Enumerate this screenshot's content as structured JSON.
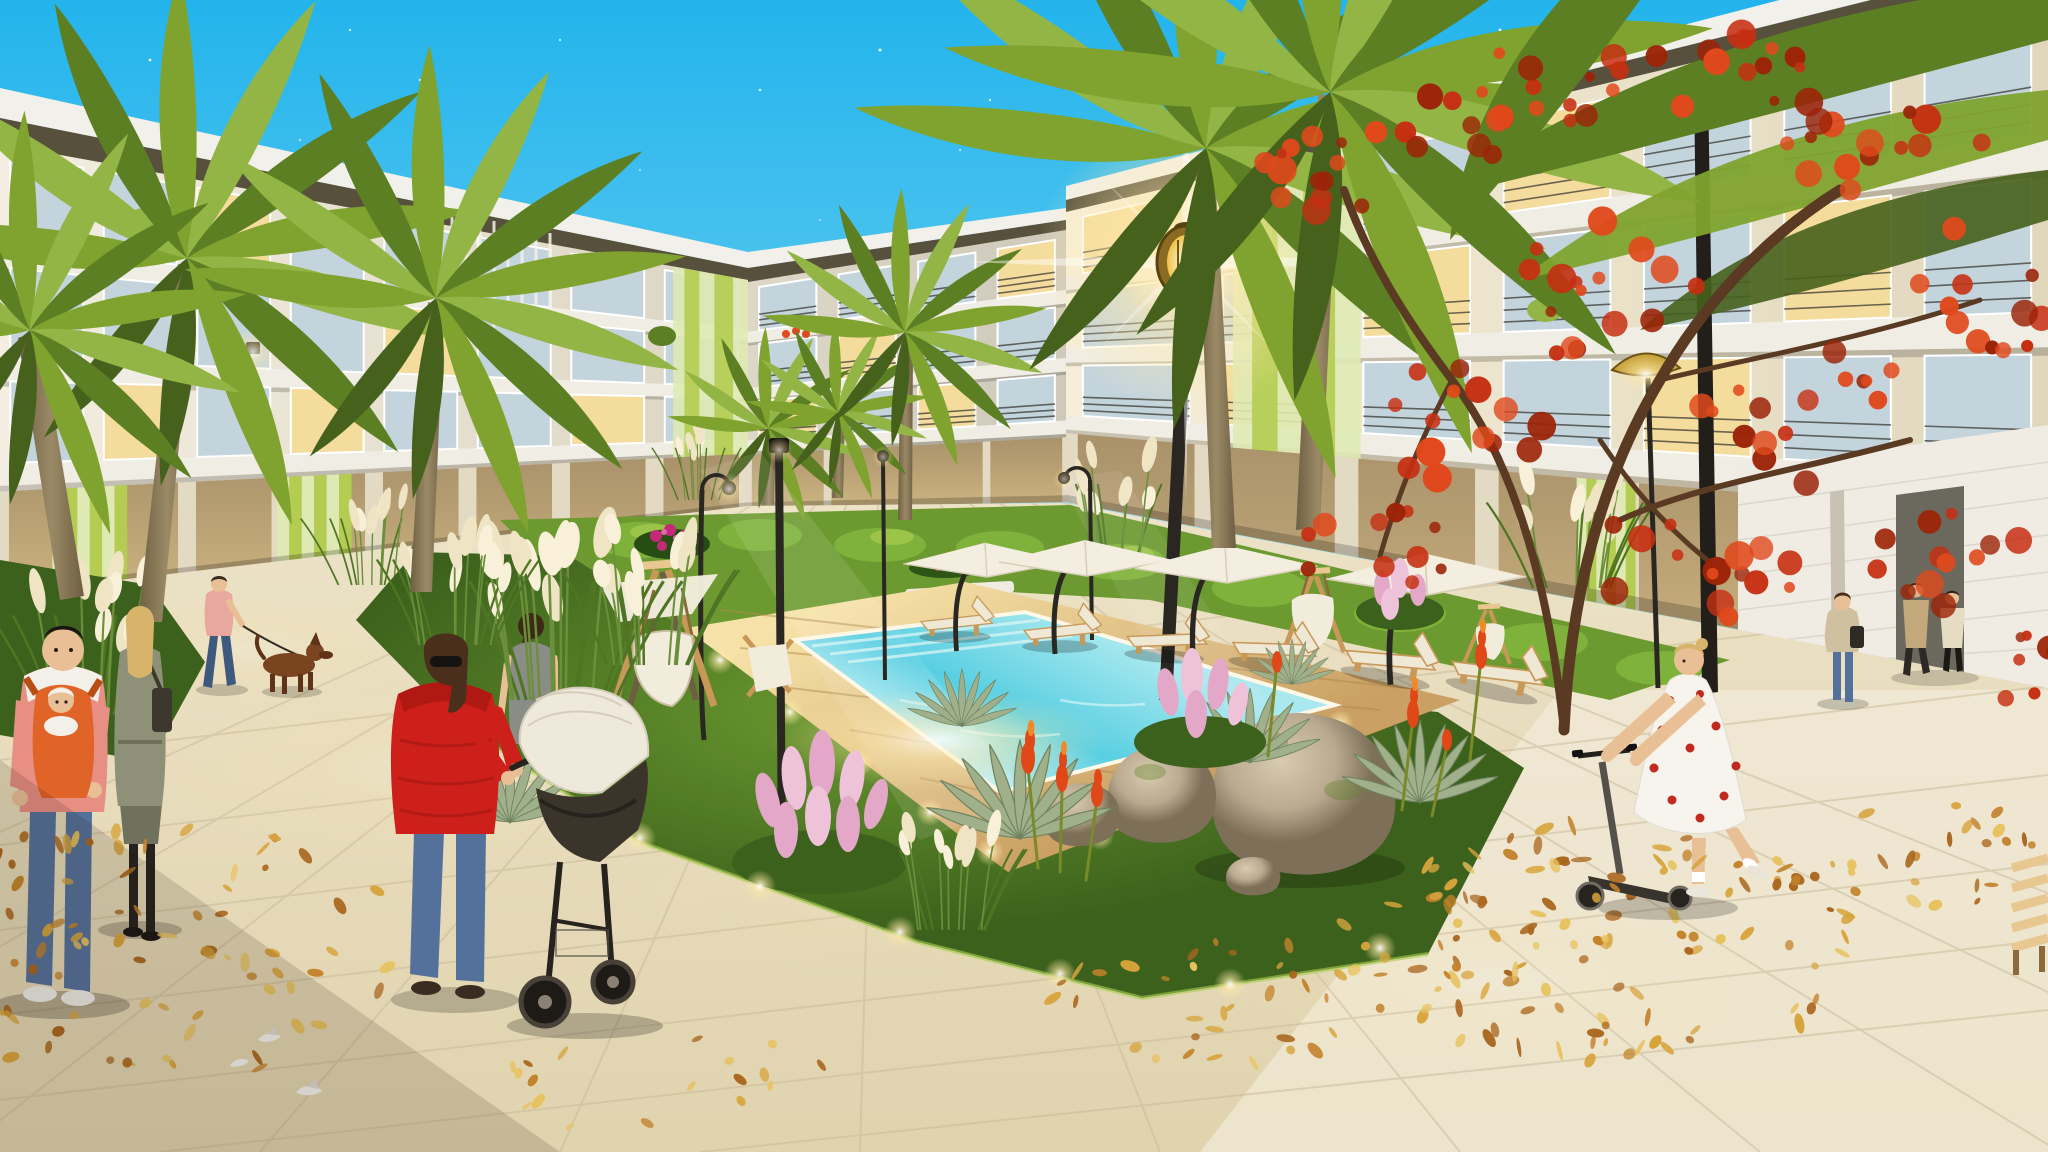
{
  "labels": {
    "scene": "Evening 3D architectural rendering of a residential complex courtyard with a glowing swimming pool, palm trees, autumn leaves and residents strolling",
    "sky": "dusk sky with stars",
    "stars": "stars",
    "left_building": "left apartment wing with balconies and green accent storefront",
    "far_building": "far apartment block at courtyard corner",
    "right_building": "right apartment wing with green accent panels",
    "garden_wall": "white garden wall with passage",
    "pavement": "beige stone plaza paving",
    "pool": "glowing turquoise swimming pool",
    "pool_deck": "wooden pool deck",
    "garden_bed": "landscaped garden bed with grasses, agaves and boulders",
    "far_lawn": "lawn strip with hedges and flowers",
    "palms": "palm trees",
    "red_tree": "red autumn tree",
    "street_lamp": "glowing street lamp",
    "walkway_lamps": "courtyard walkway lamps",
    "umbrellas": "white patio umbrellas",
    "loungers": "sun loungers",
    "swings": "wooden swing seats",
    "leaves": "fallen autumn leaves",
    "doves": "white doves on the pavement",
    "man_baby": "man carrying a baby in a chest carrier",
    "woman_coat": "woman in a long coat walking away",
    "man_dog": "man in a pink shirt walking a brown dog",
    "dog": "brown dog on a leash",
    "woman_red": "woman in a red jacket pushing a stroller",
    "stroller": "baby stroller",
    "woman_grey": "woman in a grey top walking toward the garden",
    "girl_scooter": "girl in a polka-dot dress riding a kick scooter",
    "woman_standing": "woman standing under the red tree",
    "couple_walking": "couple walking away near the wall",
    "pedestrian": "pedestrian near the storefront",
    "bench": "wooden bench at the right edge"
  },
  "colors": {
    "skyTop": "#23b4ec",
    "skyMid": "#7fd6f2",
    "skyLow": "#eaf8fc",
    "fascia": "#f2f0ea",
    "eaveDark": "#57503c",
    "faceA": "#f3eee1",
    "faceB": "#dcd5c2",
    "faceC1": "#ddd7c8",
    "faceC2": "#cfc9ba",
    "faceR1": "#f6eed8",
    "faceR2": "#e0d7bd",
    "glass": "#c4d4dd",
    "glassLit": "#f4dc9c",
    "frame": "#ffffff",
    "slab": "#f0ede4",
    "railing": "#3b3a34",
    "greenPale": "#dfe9b4",
    "greenMid": "#b5cc52",
    "greenDark": "#8fb32e",
    "storeGlass": "#a9916a",
    "pier": "#e3dac4",
    "wallWhite": "#f0ece3",
    "doorway": "#6b685e",
    "pavement": "#ece2c6",
    "pavement2": "#e0d3ae",
    "pavementLight": "#f2ecdc",
    "joint": "#c9ba98",
    "deck": "#caa064",
    "deckLit": "#f6e2a8",
    "plank": "#b08a50",
    "poolFar": "#a8e8ee",
    "poolMid": "#58cfe2",
    "poolNear": "#f2fdfa",
    "coping": "#fff8e6",
    "grass": "#6c9a30",
    "grassDark": "#3c611c",
    "grassLit": "#a8cc50",
    "hedge": "#7fb23a",
    "plume": "#efe4c4",
    "plumeLit": "#f8f0d8",
    "blade": "#4f7524",
    "pinkPlume": "#e3a8c8",
    "pinkLight": "#eec3da",
    "magenta": "#c42a78",
    "aloeRed": "#e04818",
    "aloeTip": "#f08a28",
    "agave": "#9fb08a",
    "agaveDark": "#6f8260",
    "boulder": "#b9aa90",
    "boulderDark": "#7d6f58",
    "boulderLit": "#d8cbb0",
    "trunk": "#9b8a66",
    "trunkDark": "#6e5f43",
    "palm1": "#7fa32e",
    "palm2": "#5d7f23",
    "palm3": "#93b545",
    "palmDark": "#46611c",
    "redLeaf1": "#c62f12",
    "redLeaf2": "#e0491c",
    "redLeaf3": "#9c2408",
    "branch": "#5a3a22",
    "lampPole": "#2a2722",
    "lampGold": "#c9a43e",
    "lampGlow": "#ffe9a8",
    "wood": "#c89858",
    "woodLit": "#e8c890",
    "sling": "#f2ecdc",
    "cushion": "#efe8d4",
    "umbrella": "#f4eee0",
    "leaf1": "#d7a43c",
    "leaf2": "#c2822a",
    "leaf3": "#e7c25e",
    "leaf4": "#a9661e",
    "skin": "#e9bf96",
    "jacketRed": "#ce201a",
    "jeans": "#54719c",
    "jeansDark": "#3f587e",
    "coatGrey": "#8f9078",
    "hairBlonde": "#d8b46a",
    "hairBrown": "#4a2f1c",
    "shirtPink": "#e8a8a0",
    "shirtSalmon": "#e88f84",
    "whiteCloth": "#f6f3ec",
    "tan": "#c2a87a",
    "cream": "#e6dcc4",
    "grey": "#8a8d85",
    "babyOrange": "#e06428",
    "dogBrown": "#7a4420",
    "strollerBody": "#3b342b",
    "strollerHood": "#efe9dc",
    "frameDark": "#26221e"
  },
  "stars": [
    [
      150,
      60,
      1.4,
      0.9
    ],
    [
      300,
      140,
      1.2,
      0.6
    ],
    [
      90,
      220,
      1.1,
      0.5
    ],
    [
      420,
      80,
      1.3,
      0.8
    ],
    [
      560,
      40,
      1.2,
      0.7
    ],
    [
      640,
      170,
      1.1,
      0.5
    ],
    [
      760,
      90,
      1.3,
      0.8
    ],
    [
      880,
      50,
      1.5,
      0.9
    ],
    [
      960,
      150,
      1.2,
      0.6
    ],
    [
      1030,
      30,
      1.3,
      0.8
    ],
    [
      1090,
      210,
      1.1,
      0.5
    ],
    [
      1140,
      90,
      1.6,
      0.9
    ],
    [
      1230,
      40,
      1.3,
      0.7
    ],
    [
      1300,
      150,
      1.4,
      0.8
    ],
    [
      1370,
      70,
      1.2,
      0.6
    ],
    [
      1430,
      230,
      1.1,
      0.5
    ],
    [
      1500,
      30,
      1.5,
      0.9
    ],
    [
      1560,
      120,
      1.3,
      0.7
    ],
    [
      1620,
      60,
      1.2,
      0.8
    ],
    [
      1700,
      180,
      1.4,
      0.6
    ],
    [
      1760,
      40,
      1.3,
      0.8
    ],
    [
      1820,
      140,
      1.2,
      0.6
    ],
    [
      1880,
      90,
      1.6,
      0.9
    ],
    [
      1930,
      220,
      1.2,
      0.5
    ],
    [
      1980,
      50,
      1.4,
      0.8
    ],
    [
      2020,
      160,
      1.2,
      0.6
    ],
    [
      1240,
      260,
      1.1,
      0.5
    ],
    [
      1080,
      330,
      1.0,
      0.4
    ],
    [
      1650,
      300,
      1.2,
      0.5
    ],
    [
      1750,
      260,
      1.1,
      0.5
    ],
    [
      480,
      240,
      1.0,
      0.4
    ],
    [
      220,
      300,
      1.0,
      0.4
    ],
    [
      700,
      280,
      1.0,
      0.4
    ],
    [
      820,
      220,
      1.1,
      0.5
    ],
    [
      1480,
      170,
      1.2,
      0.6
    ],
    [
      1540,
      260,
      1.0,
      0.4
    ],
    [
      1860,
      320,
      1.1,
      0.4
    ],
    [
      1960,
      300,
      1.0,
      0.4
    ],
    [
      350,
      30,
      1.2,
      0.7
    ],
    [
      520,
      130,
      1.1,
      0.5
    ],
    [
      990,
      100,
      1.2,
      0.7
    ],
    [
      1175,
      150,
      1.1,
      0.5
    ],
    [
      905,
      300,
      1.0,
      0.4
    ],
    [
      1335,
      320,
      1.0,
      0.4
    ]
  ],
  "facades": [
    {
      "id": "far",
      "tl": [
        748,
        252
      ],
      "tr": [
        1066,
        208
      ],
      "bl": [
        748,
        508
      ],
      "br": [
        1066,
        502
      ],
      "fascia": [
        16,
        12
      ],
      "eave": [
        14,
        10
      ],
      "face": "url(#faceC)",
      "rows": [
        [
          0.03,
          0.22
        ],
        [
          0.28,
          0.47
        ],
        [
          0.53,
          0.7
        ]
      ],
      "slabH": 0.05,
      "bays": 4,
      "winW": 0.72,
      "lit": [
        [
          2,
          0
        ],
        [
          2,
          2
        ],
        [
          1,
          1
        ],
        [
          0,
          3
        ]
      ],
      "railings": true,
      "greenBand": null,
      "groundGreens": []
    },
    {
      "id": "left",
      "tl": [
        0,
        88
      ],
      "tr": [
        748,
        252
      ],
      "bl": [
        0,
        600
      ],
      "br": [
        748,
        508
      ],
      "fascia": [
        30,
        16
      ],
      "eave": [
        26,
        12
      ],
      "face": "url(#faceL)",
      "rows": [
        [
          0.02,
          0.22
        ],
        [
          0.27,
          0.47
        ],
        [
          0.52,
          0.7
        ]
      ],
      "slabH": 0.05,
      "bays": 8,
      "winW": 0.78,
      "lit": [
        [
          2,
          1
        ],
        [
          2,
          3
        ],
        [
          2,
          6
        ],
        [
          1,
          4
        ],
        [
          0,
          2
        ]
      ],
      "railings": false,
      "greenBand": [
        0.9,
        1.0
      ],
      "groundGreens": [
        [
          0.07,
          0.17
        ],
        [
          0.37,
          0.47
        ]
      ]
    },
    {
      "id": "right",
      "tl": [
        1066,
        186
      ],
      "tr": [
        2048,
        -70
      ],
      "bl": [
        1066,
        502
      ],
      "br": [
        2048,
        688
      ],
      "fascia": [
        14,
        26
      ],
      "eave": [
        12,
        22
      ],
      "face": "url(#faceR)",
      "rows": [
        [
          0.03,
          0.22
        ],
        [
          0.28,
          0.47
        ],
        [
          0.53,
          0.7
        ]
      ],
      "slabH": 0.05,
      "bays": 7,
      "winW": 0.76,
      "lit": [
        [
          2,
          1
        ],
        [
          2,
          4
        ],
        [
          1,
          2
        ],
        [
          1,
          5
        ],
        [
          0,
          0
        ],
        [
          0,
          3
        ]
      ],
      "railings": true,
      "greenBand": [
        0.17,
        0.3
      ],
      "groundGreens": [
        [
          0.52,
          0.58
        ]
      ]
    }
  ],
  "palms": {
    "angles": [
      -168,
      -140,
      -112,
      -86,
      -58,
      -30,
      -4,
      22,
      48,
      74
    ],
    "droop": [
      102,
      134
    ],
    "left": [
      {
        "cx": 187,
        "cy": 258,
        "s": 1.7
      },
      {
        "cx": 436,
        "cy": 298,
        "s": 1.5
      },
      {
        "cx": 30,
        "cy": 330,
        "s": 1.3
      }
    ],
    "far": [
      {
        "cx": 768,
        "cy": 428,
        "s": 0.6
      },
      {
        "cx": 838,
        "cy": 412,
        "s": 0.55
      },
      {
        "cx": 905,
        "cy": 332,
        "s": 0.85
      }
    ],
    "right": [
      {
        "cx": 1206,
        "cy": 148,
        "s": 2.1
      },
      {
        "cx": 1330,
        "cy": 92,
        "s": 2.3
      }
    ]
  },
  "pampas": [
    {
      "cx": 370,
      "cy": 585,
      "s": 0.7,
      "n": 7,
      "layer": "far"
    },
    {
      "cx": 700,
      "cy": 500,
      "s": 0.55,
      "n": 6,
      "layer": "far"
    },
    {
      "cx": 1115,
      "cy": 560,
      "s": 0.8,
      "n": 8,
      "layer": "far"
    },
    {
      "cx": 1572,
      "cy": 588,
      "s": 0.9,
      "n": 8,
      "layer": "far"
    },
    {
      "cx": 560,
      "cy": 700,
      "s": 1.25,
      "n": 11,
      "layer": "near"
    },
    {
      "cx": 455,
      "cy": 645,
      "s": 0.9,
      "n": 8,
      "layer": "near"
    },
    {
      "cx": 645,
      "cy": 665,
      "s": 1.0,
      "n": 9,
      "layer": "near"
    },
    {
      "cx": 90,
      "cy": 715,
      "s": 1.05,
      "n": 9,
      "layer": "near"
    },
    {
      "cx": 950,
      "cy": 930,
      "s": 0.85,
      "n": 7,
      "layer": "near"
    }
  ],
  "agaves": [
    {
      "cx": 1020,
      "cy": 838,
      "s": 1.2
    },
    {
      "cx": 510,
      "cy": 822,
      "s": 0.95
    },
    {
      "cx": 1250,
      "cy": 762,
      "s": 0.9
    },
    {
      "cx": 1420,
      "cy": 802,
      "s": 1.0
    },
    {
      "cx": 1292,
      "cy": 684,
      "s": 0.55
    },
    {
      "cx": 962,
      "cy": 726,
      "s": 0.7
    }
  ],
  "leaf_clusters": [
    {
      "id": "l1",
      "cx": 160,
      "cy": 950,
      "rx": 240,
      "ry": 140,
      "n": 85
    },
    {
      "id": "l2",
      "cx": 1600,
      "cy": 945,
      "rx": 270,
      "ry": 120,
      "n": 110
    },
    {
      "id": "l3",
      "cx": 1945,
      "cy": 855,
      "rx": 130,
      "ry": 55,
      "n": 26
    },
    {
      "id": "l4",
      "cx": 1210,
      "cy": 1005,
      "rx": 170,
      "ry": 70,
      "n": 32
    },
    {
      "id": "l5",
      "cx": 660,
      "cy": 1080,
      "rx": 170,
      "ry": 55,
      "n": 18
    },
    {
      "id": "l6",
      "cx": 1640,
      "cy": 900,
      "rx": 130,
      "ry": 60,
      "n": 16
    }
  ],
  "red_clusters": [
    [
      1340,
      165,
      95,
      60,
      16
    ],
    [
      1510,
      105,
      105,
      55,
      16
    ],
    [
      1700,
      75,
      115,
      50,
      16
    ],
    [
      1885,
      140,
      100,
      60,
      15
    ],
    [
      1990,
      290,
      85,
      70,
      14
    ],
    [
      1600,
      290,
      115,
      70,
      16
    ],
    [
      1450,
      420,
      100,
      60,
      14
    ],
    [
      1820,
      420,
      125,
      75,
      16
    ],
    [
      1690,
      565,
      115,
      60,
      15
    ],
    [
      1960,
      560,
      90,
      60,
      12
    ],
    [
      1368,
      545,
      85,
      55,
      11
    ],
    [
      2012,
      672,
      60,
      40,
      8
    ]
  ]
}
